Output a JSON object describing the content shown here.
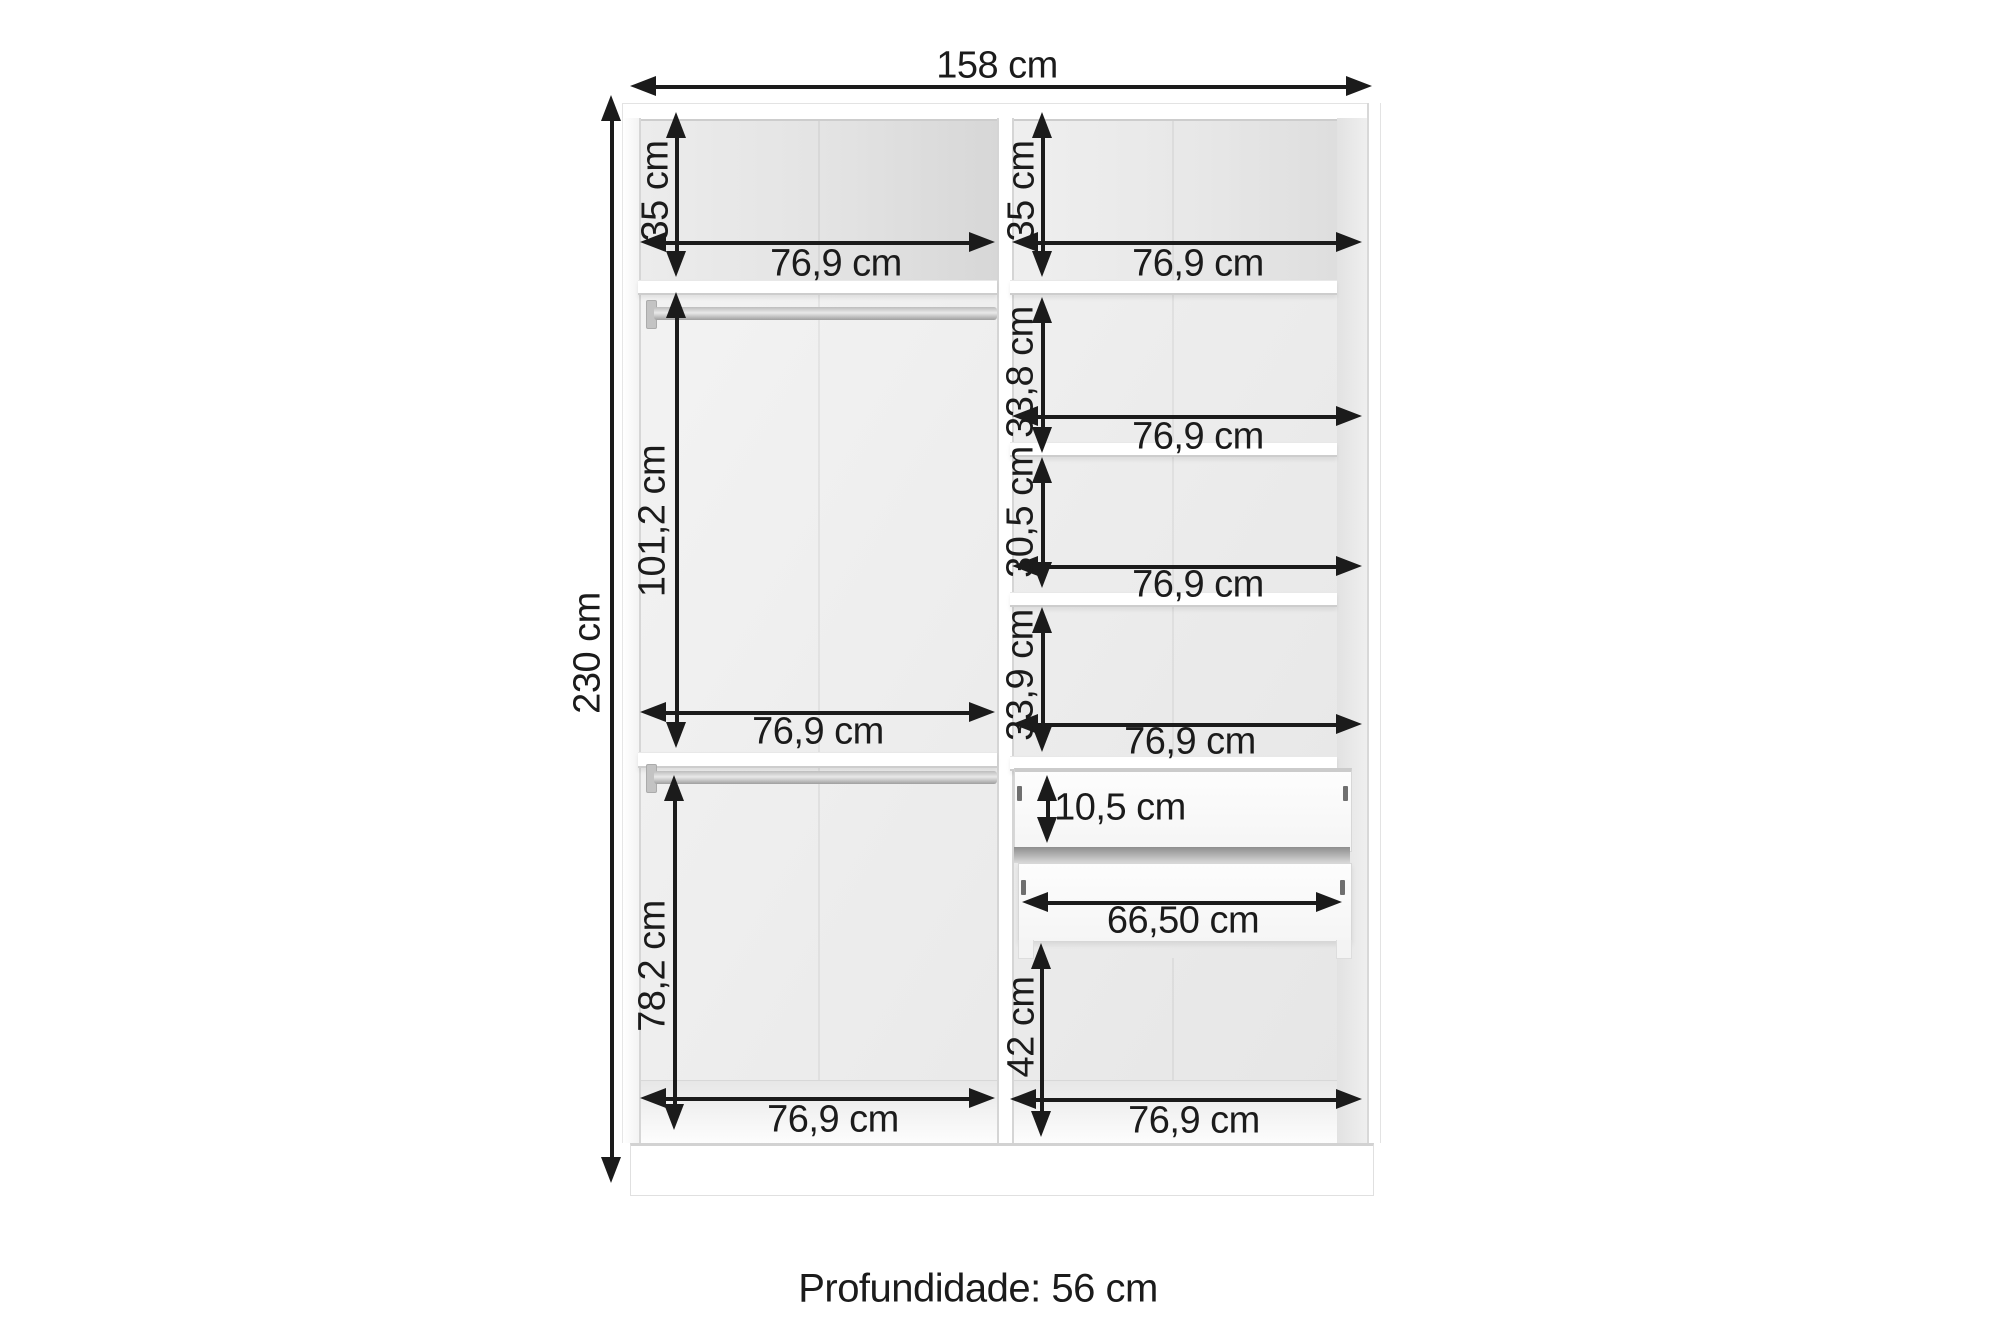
{
  "diagram": {
    "overall": {
      "width": "158 cm",
      "height": "230 cm",
      "depth": "Profundidade: 56 cm"
    },
    "left_column": {
      "section1_height": "35 cm",
      "section1_width": "76,9 cm",
      "section2_height": "101,2 cm",
      "section2_width": "76,9 cm",
      "section3_height": "78,2 cm",
      "section3_width": "76,9 cm"
    },
    "right_column": {
      "section1_height": "35 cm",
      "section1_width": "76,9 cm",
      "section2_height": "33,8 cm",
      "section2_width": "76,9 cm",
      "section3_height": "30,5 cm",
      "section3_width": "76,9 cm",
      "section4_height": "33,9 cm",
      "section4_width": "76,9 cm",
      "drawer_height": "10,5 cm",
      "drawer_width": "66,50 cm",
      "section5_height": "42 cm",
      "section5_width": "76,9 cm"
    }
  }
}
